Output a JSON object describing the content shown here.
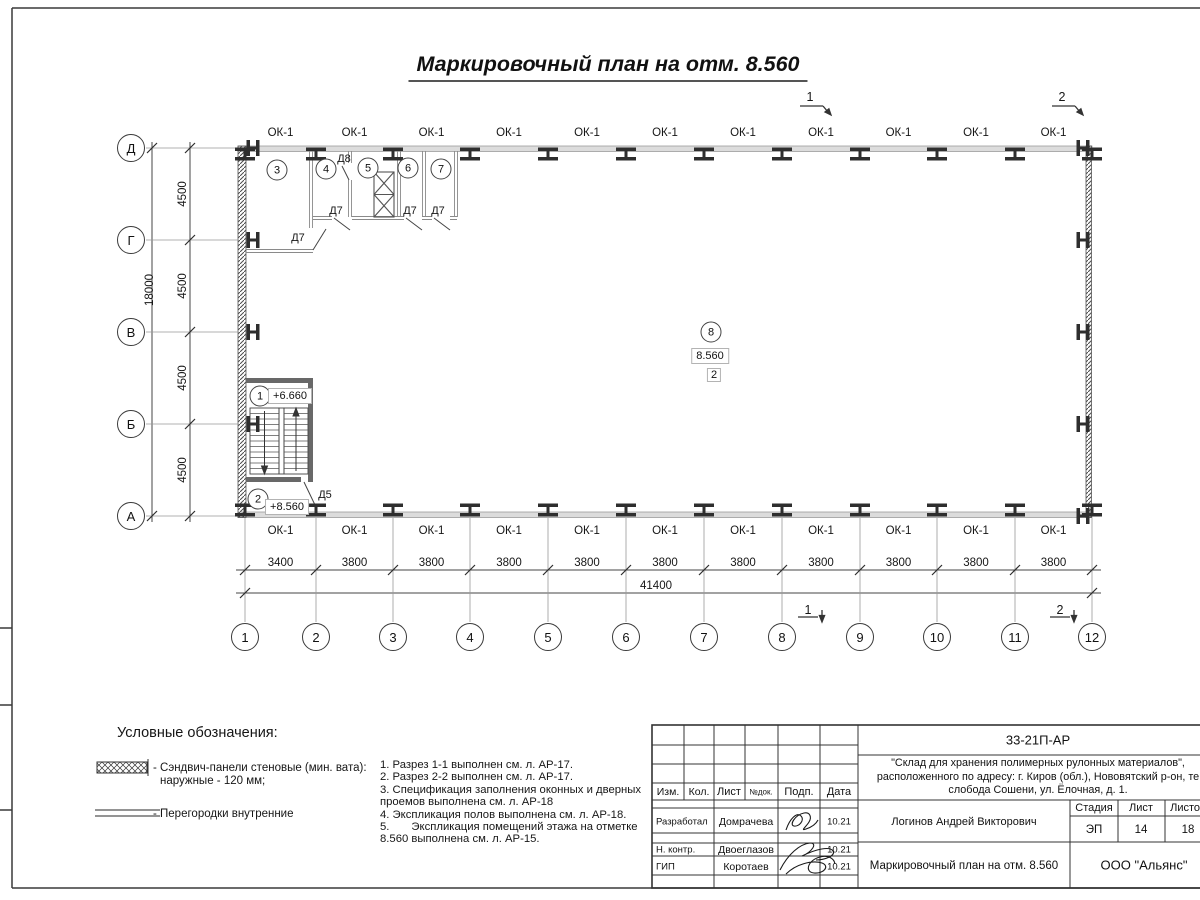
{
  "sheet": {
    "title": "Маркировочный план на отм. 8.560"
  },
  "plan": {
    "window_mark": "ОК-1",
    "axes_bottom": [
      "1",
      "2",
      "3",
      "4",
      "5",
      "6",
      "7",
      "8",
      "9",
      "10",
      "11",
      "12"
    ],
    "axes_left": [
      "Д",
      "Г",
      "В",
      "Б",
      "А"
    ],
    "bay_dims": [
      "3400",
      "3800",
      "3800",
      "3800",
      "3800",
      "3800",
      "3800",
      "3800",
      "3800",
      "3800",
      "3800"
    ],
    "total_width": "41400",
    "row_dims": [
      "4500",
      "4500",
      "4500",
      "4500"
    ],
    "total_depth": "18000",
    "room_tags": [
      "1",
      "2",
      "3",
      "4",
      "5",
      "6",
      "7",
      "8"
    ],
    "level_stair_upper": "+6.660",
    "level_stair_lower": "+8.560",
    "level_hall": "8.560",
    "zone_tag": "2",
    "door_d5": "Д5",
    "door_d7": "Д7",
    "door_d8": "Д8",
    "section_1": "1",
    "section_2": "2"
  },
  "legend": {
    "heading": "Условные обозначения:",
    "sandwich_line1": "- Сэндвич-панели стеновые (мин. вата):",
    "sandwich_line2": "наружные - 120 мм;",
    "partitions": "- Перегородки внутренние"
  },
  "notes": [
    "1. Разрез 1-1 выполнен см. л. АР-17.",
    "2. Разрез 2-2 выполнен см. л. АР-17.",
    "3. Спецификация заполнения оконных и дверных",
    "проемов выполнена см. л. АР-18",
    "4. Экспликация полов выполнена см. л. АР-18.",
    "5.       Экспликация помещений этажа на отметке",
    "8.560 выполнена см. л. АР-15."
  ],
  "titleblock": {
    "doc_code": "33-21П-АР",
    "project_line1": "\"Склад для хранения полимерных рулонных материалов\",",
    "project_line2": "расположенного по адресу: г. Киров (обл.), Нововятский р-он, те",
    "project_line3": "слобода Сошени, ул. Ёлочная, д. 1.",
    "col_izm": "Изм.",
    "col_kol": "Кол.",
    "col_list": "Лист",
    "col_ndok": "№док.",
    "col_podp": "Подп.",
    "col_data": "Дата",
    "row1_role": "Разработал",
    "row1_name": "Домрачева",
    "row1_date": "10.21",
    "row2_role": "Н. контр.",
    "row2_name": "Двоеглазов",
    "row2_date": "10.21",
    "row3_role": "ГИП",
    "row3_name": "Коротаев",
    "row3_date": "10.21",
    "approver": "Логинов Андрей Викторович",
    "stage_label": "Стадия",
    "sheet_label": "Лист",
    "sheets_label": "Листов",
    "stage": "ЭП",
    "sheet_no": "14",
    "sheets_total": "18",
    "drawing_title": "Маркировочный план на отм. 8.560",
    "company": "ООО \"Альянс\""
  }
}
